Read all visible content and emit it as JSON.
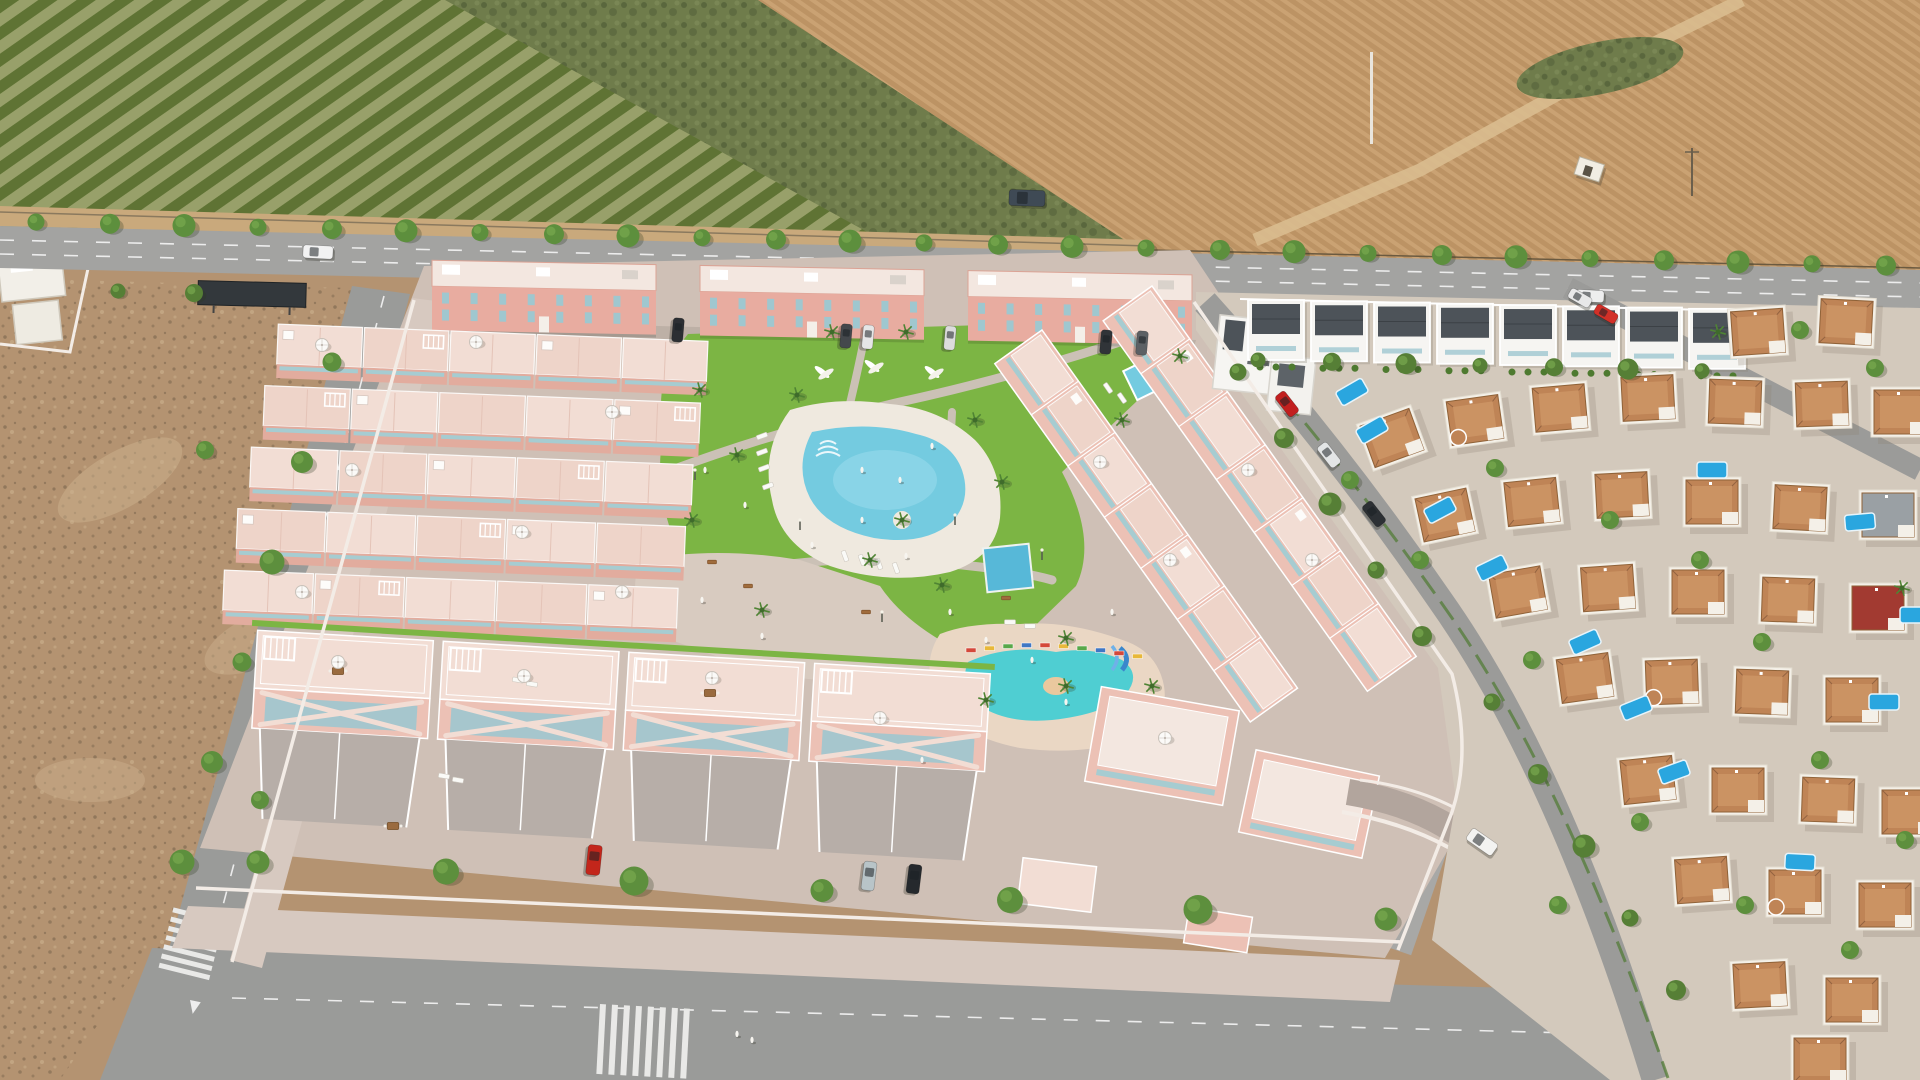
{
  "meta": {
    "title": "Aerial view of a new-build pink townhouse development with central pool park, bordered by orchards, plowed farmland, vacant lots and an existing villa neighborhood",
    "width": 1920,
    "height": 1080
  },
  "palette": {
    "orchardLight": "#98a06a",
    "orchardRow": "#5f7334",
    "scrub": "#6f7c4b",
    "scrubDark": "#55613a",
    "field": "#bc9364",
    "fieldLight": "#caa273",
    "track": "#d9bd8f",
    "shoulder": "#c9a97c",
    "fence": "#6b5a40",
    "roadA": "#a3a3a1",
    "roadB": "#9a9b99",
    "marking": "#ececec",
    "dirt": "#b49371",
    "dirtDark": "#6d5c45",
    "dirtLight": "#ccb18d",
    "pave": "#cfc0b6",
    "paveDark": "#bdb0a6",
    "walk": "#d7c9c0",
    "wallWhite": "#f3ece6",
    "pink": "#ecc1b5",
    "pinkDark": "#dba395",
    "pinkWall": "#e2ac9e",
    "terrace": "#f2ddd4",
    "terraceAlt": "#eed4c9",
    "facade": "#e8aca0",
    "roofWhite": "#f3e7e0",
    "teal": "#a6ccd1",
    "tealWin": "#9fc7cf",
    "grass": "#7cb544",
    "grassDark": "#639a35",
    "hedge": "#4e7a30",
    "treeFill": "#5d8f3d",
    "treeDark": "#466f2c",
    "palm": "#3f6b2b",
    "lagoon": "#74cbe0",
    "lagoonLight": "#9bdcec",
    "poolDeck": "#efe9df",
    "kidsPool": "#4fced2",
    "kidsDeck": "#ead7c4",
    "poolBlue": "#57b8d8",
    "privatePool": "#2aa6df",
    "villaWhite": "#f4f0e8",
    "villaRoof": "#bf8456",
    "villaRoofLight": "#d09a6a",
    "redRoof": "#a23a31",
    "grayRoof": "#9aa0a4",
    "modernRoof": "#4d5359",
    "neighborhoodGround": "#d3c9bc",
    "carWhite": "#f2f2f2",
    "carRed": "#c3261b",
    "carDark": "#25292d",
    "carSilver": "#b8c4c8",
    "vanDark": "#3f4a55"
  },
  "scene": {
    "regions": [
      {
        "name": "orchard-field",
        "desc": "row-planted orchard, top left"
      },
      {
        "name": "scrubland",
        "desc": "unplanted scrub, top centre"
      },
      {
        "name": "plowed-field",
        "desc": "brown plowed farmland, top right"
      },
      {
        "name": "main-road",
        "desc": "tree-lined avenue across the top"
      },
      {
        "name": "development",
        "desc": "pink render: townhouses around pool park"
      },
      {
        "name": "vacant-lot",
        "desc": "dirt plot, lower left"
      },
      {
        "name": "villa-neighborhood",
        "desc": "existing white villas with private pools, right"
      }
    ]
  },
  "objects": {
    "tree_rows": [
      {
        "name": "main-road-north",
        "x0": 36,
        "y0": 222,
        "dx": 74,
        "dy": 1.74,
        "n": 26,
        "r": 10,
        "color": "#5d8f3d"
      },
      {
        "name": "main-road-south-west",
        "x0": 118,
        "y0": 291,
        "dx": 76,
        "dy": 2,
        "n": 2,
        "r": 9,
        "color": "#567f36"
      },
      {
        "name": "main-road-south-east",
        "x0": 1258,
        "y0": 360,
        "dx": 74,
        "dy": 1.8,
        "n": 7,
        "r": 9,
        "color": "#567f36"
      },
      {
        "name": "left-road",
        "x0": 332,
        "y0": 362,
        "dx": -30,
        "dy": 100,
        "n": 6,
        "r": 11,
        "color": "#5d8f3d"
      },
      {
        "name": "bottom-sidewalk",
        "x0": 258,
        "y0": 862,
        "dx": 188,
        "dy": 9.5,
        "n": 7,
        "r": 13,
        "color": "#5d8f3d"
      },
      {
        "name": "development-street",
        "x0": 1238,
        "y0": 372,
        "dx": 46,
        "dy": 66,
        "n": 5,
        "r": 10,
        "color": "#567f36"
      },
      {
        "name": "neighborhood-street-lower",
        "x0": 1492,
        "y0": 702,
        "dx": 46,
        "dy": 72,
        "n": 5,
        "r": 10,
        "color": "#567f36"
      }
    ],
    "trees": [
      [
        1350,
        480
      ],
      [
        1495,
        468
      ],
      [
        1420,
        560
      ],
      [
        1610,
        520
      ],
      [
        1700,
        560
      ],
      [
        1762,
        642
      ],
      [
        1532,
        660
      ],
      [
        1820,
        760
      ],
      [
        1640,
        822
      ],
      [
        1745,
        905
      ],
      [
        1850,
        950
      ],
      [
        1905,
        840
      ],
      [
        1558,
        905
      ],
      [
        260,
        800
      ],
      [
        205,
        450
      ],
      [
        1875,
        368
      ],
      [
        1800,
        330
      ]
    ],
    "palms": [
      [
        700,
        390
      ],
      [
        737,
        455
      ],
      [
        692,
        520
      ],
      [
        797,
        395
      ],
      [
        975,
        420
      ],
      [
        1002,
        482
      ],
      [
        870,
        560
      ],
      [
        942,
        585
      ],
      [
        1066,
        638
      ],
      [
        1152,
        686
      ],
      [
        986,
        700
      ],
      [
        762,
        610
      ],
      [
        1122,
        420
      ],
      [
        1180,
        356
      ],
      [
        906,
        332
      ],
      [
        832,
        332
      ],
      [
        1066,
        686
      ],
      [
        902,
        520
      ],
      [
        1718,
        332
      ],
      [
        1902,
        588
      ]
    ],
    "cars": [
      {
        "n": "car-white-road",
        "x": 318,
        "y": 252,
        "rot": 3,
        "c": "#f2f2f2",
        "w": 30,
        "h": 13
      },
      {
        "n": "car-white-road-2",
        "x": 1590,
        "y": 296,
        "rot": 3,
        "c": "#eeeeee",
        "w": 28,
        "h": 12
      },
      {
        "n": "van-field",
        "x": 1027,
        "y": 198,
        "rot": 2,
        "c": "#3f4a55",
        "w": 36,
        "h": 16
      },
      {
        "n": "car-parked-1",
        "x": 678,
        "y": 330,
        "rot": 95,
        "c": "#2c2f33",
        "w": 24,
        "h": 11
      },
      {
        "n": "car-parked-2",
        "x": 846,
        "y": 336,
        "rot": 95,
        "c": "#44484c",
        "w": 24,
        "h": 11
      },
      {
        "n": "car-parked-3",
        "x": 868,
        "y": 337,
        "rot": 95,
        "c": "#e6e6e6",
        "w": 24,
        "h": 11
      },
      {
        "n": "car-parked-4",
        "x": 950,
        "y": 338,
        "rot": 95,
        "c": "#dcdcdc",
        "w": 24,
        "h": 11
      },
      {
        "n": "car-parked-5",
        "x": 1106,
        "y": 342,
        "rot": 95,
        "c": "#303438",
        "w": 24,
        "h": 11
      },
      {
        "n": "car-parked-6",
        "x": 1142,
        "y": 343,
        "rot": 95,
        "c": "#5c6064",
        "w": 24,
        "h": 11
      },
      {
        "n": "car-red-driveway",
        "x": 594,
        "y": 860,
        "rot": 96,
        "c": "#c3261b",
        "w": 30,
        "h": 14
      },
      {
        "n": "car-silver-driveway",
        "x": 869,
        "y": 876,
        "rot": 97,
        "c": "#b8c4c8",
        "w": 29,
        "h": 13
      },
      {
        "n": "car-black-driveway",
        "x": 914,
        "y": 879,
        "rot": 97,
        "c": "#25292d",
        "w": 29,
        "h": 13
      },
      {
        "n": "suv-white-ramp",
        "x": 1482,
        "y": 842,
        "rot": 35,
        "c": "#f3f3f1",
        "w": 31,
        "h": 14
      },
      {
        "n": "car-red-street",
        "x": 1287,
        "y": 404,
        "rot": 52,
        "c": "#c21f1f",
        "w": 26,
        "h": 12
      },
      {
        "n": "car-white-street",
        "x": 1329,
        "y": 455,
        "rot": 52,
        "c": "#e3e5e6",
        "w": 26,
        "h": 12
      },
      {
        "n": "car-dark-street",
        "x": 1374,
        "y": 514,
        "rot": 52,
        "c": "#2c3034",
        "w": 26,
        "h": 12
      },
      {
        "n": "car-white-street-2",
        "x": 1580,
        "y": 298,
        "rot": 30,
        "c": "#e8e8e8",
        "w": 24,
        "h": 11
      },
      {
        "n": "car-red-street-2",
        "x": 1606,
        "y": 314,
        "rot": 30,
        "c": "#d23028",
        "w": 24,
        "h": 11
      }
    ],
    "villas": [
      [
        1758,
        332,
        -4,
        0
      ],
      [
        1846,
        322,
        3,
        0
      ],
      [
        1392,
        438,
        -20,
        0
      ],
      [
        1475,
        420,
        -8,
        1
      ],
      [
        1560,
        408,
        -5,
        0
      ],
      [
        1648,
        398,
        -3,
        0
      ],
      [
        1735,
        402,
        2,
        0
      ],
      [
        1822,
        404,
        -2,
        0
      ],
      [
        1900,
        412,
        0,
        0
      ],
      [
        1445,
        515,
        -12,
        0
      ],
      [
        1532,
        502,
        -6,
        0
      ],
      [
        1622,
        495,
        -3,
        0
      ],
      [
        1712,
        502,
        0,
        0
      ],
      [
        1800,
        508,
        3,
        0
      ],
      [
        1888,
        515,
        0,
        3
      ],
      [
        1518,
        592,
        -10,
        0
      ],
      [
        1608,
        588,
        -4,
        0
      ],
      [
        1698,
        592,
        0,
        0
      ],
      [
        1788,
        600,
        2,
        0
      ],
      [
        1878,
        608,
        0,
        2
      ],
      [
        1585,
        678,
        -8,
        0
      ],
      [
        1672,
        682,
        -2,
        1
      ],
      [
        1762,
        692,
        2,
        0
      ],
      [
        1852,
        700,
        0,
        0
      ],
      [
        1648,
        780,
        -6,
        0
      ],
      [
        1738,
        790,
        0,
        0
      ],
      [
        1828,
        800,
        2,
        0
      ],
      [
        1908,
        812,
        0,
        0
      ],
      [
        1702,
        880,
        -4,
        0
      ],
      [
        1795,
        892,
        0,
        1
      ],
      [
        1885,
        905,
        0,
        0
      ],
      [
        1760,
        985,
        -3,
        0
      ],
      [
        1852,
        1000,
        0,
        0
      ],
      [
        1820,
        1060,
        0,
        0
      ]
    ],
    "private_pools": [
      [
        1372,
        430,
        -30
      ],
      [
        1440,
        510,
        -28
      ],
      [
        1492,
        568,
        -26
      ],
      [
        1585,
        642,
        -24
      ],
      [
        1636,
        708,
        -22
      ],
      [
        1674,
        772,
        -20
      ],
      [
        1712,
        470,
        0
      ],
      [
        1860,
        522,
        -5
      ],
      [
        1884,
        702,
        0
      ],
      [
        1800,
        862,
        3
      ],
      [
        1352,
        392,
        -30
      ],
      [
        1915,
        615,
        0
      ]
    ],
    "modern_row": {
      "x0": 1248,
      "step": 63,
      "n": 8,
      "y0": 300,
      "slope": 0.02,
      "w": 56,
      "h": 60
    },
    "top_blocks": [
      {
        "x": 432,
        "w": 224
      },
      {
        "x": 700,
        "w": 224
      },
      {
        "x": 968,
        "w": 224
      }
    ],
    "matrix": {
      "cx": 470,
      "cy": 560,
      "rot": 2.3,
      "h": 54,
      "rows": [
        {
          "x": 268,
          "y": 332,
          "w": 432,
          "units": 5
        },
        {
          "x": 257,
          "y": 394,
          "w": 438,
          "units": 5
        },
        {
          "x": 246,
          "y": 456,
          "w": 444,
          "units": 5
        },
        {
          "x": 235,
          "y": 518,
          "w": 450,
          "units": 5
        },
        {
          "x": 224,
          "y": 580,
          "w": 456,
          "units": 5
        }
      ]
    },
    "front": {
      "cx": 620,
      "cy": 770,
      "rot": 3.4,
      "y": 652,
      "w": 176,
      "terH": 58,
      "facH": 40,
      "driveH": 90,
      "units": [
        250,
        436,
        622,
        808
      ]
    },
    "right_rows": [
      {
        "x": 1152,
        "y": 286,
        "len": 455,
        "w": 60,
        "rot": 54.5,
        "units": 7
      },
      {
        "x": 1042,
        "y": 330,
        "len": 440,
        "w": 58,
        "rot": 54.5,
        "units": 7
      }
    ],
    "umbrellas": [
      [
        322,
        345
      ],
      [
        476,
        342
      ],
      [
        612,
        412
      ],
      [
        352,
        470
      ],
      [
        522,
        532
      ],
      [
        302,
        592
      ],
      [
        622,
        592
      ],
      [
        338,
        662
      ],
      [
        524,
        676
      ],
      [
        712,
        678
      ],
      [
        880,
        718
      ],
      [
        1100,
        462
      ],
      [
        1248,
        470
      ],
      [
        1170,
        560
      ],
      [
        1312,
        560
      ],
      [
        1165,
        738
      ]
    ],
    "loungers": [
      [
        762,
        436,
        -20
      ],
      [
        762,
        452,
        -20
      ],
      [
        764,
        468,
        -20
      ],
      [
        768,
        486,
        -20
      ],
      [
        845,
        556,
        70
      ],
      [
        862,
        560,
        70
      ],
      [
        879,
        564,
        70
      ],
      [
        896,
        568,
        70
      ],
      [
        1108,
        388,
        55
      ],
      [
        1122,
        398,
        55
      ],
      [
        1010,
        622,
        0
      ],
      [
        1030,
        626,
        0
      ],
      [
        444,
        776,
        10
      ],
      [
        458,
        780,
        10
      ],
      [
        518,
        680,
        10
      ],
      [
        532,
        684,
        10
      ]
    ],
    "people": [
      [
        705,
        470
      ],
      [
        745,
        505
      ],
      [
        812,
        545
      ],
      [
        862,
        520
      ],
      [
        906,
        556
      ],
      [
        950,
        612
      ],
      [
        986,
        640
      ],
      [
        1032,
        660
      ],
      [
        1066,
        702
      ],
      [
        900,
        480
      ],
      [
        932,
        446
      ],
      [
        862,
        470
      ],
      [
        702,
        600
      ],
      [
        762,
        636
      ],
      [
        1112,
        612
      ],
      [
        737,
        1034
      ],
      [
        752,
        1040
      ],
      [
        922,
        760
      ]
    ],
    "sculptures": [
      [
        822,
        372
      ],
      [
        872,
        366
      ],
      [
        932,
        372
      ]
    ],
    "lamps": [
      [
        695,
        480
      ],
      [
        800,
        530
      ],
      [
        955,
        525
      ],
      [
        1042,
        560
      ],
      [
        882,
        622
      ],
      [
        1092,
        480
      ],
      [
        662,
        560
      ]
    ],
    "benches": [
      [
        712,
        562
      ],
      [
        866,
        612
      ],
      [
        1006,
        598
      ],
      [
        748,
        586
      ]
    ],
    "tables": [
      [
        338,
        671
      ],
      [
        710,
        693
      ],
      [
        393,
        826
      ]
    ],
    "kids_fence": {
      "x0": 966,
      "dx": 18.5,
      "n": 10,
      "colors": [
        "#d4483a",
        "#e8b83a",
        "#58a84a",
        "#3f77c4"
      ],
      "ys": [
        648,
        646,
        644,
        643,
        643,
        644,
        646,
        648,
        651,
        654
      ]
    },
    "crosswalks": [
      {
        "x": 224,
        "y": 920,
        "rot": 104,
        "n": 7,
        "w": 5,
        "h": 52,
        "gap": 4.5
      },
      {
        "x": 600,
        "y": 1004,
        "rot": 3,
        "n": 8,
        "w": 6,
        "h": 70,
        "gap": 6
      },
      {
        "x": 1622,
        "y": 882,
        "rot": 56,
        "n": 6,
        "w": 5,
        "h": 30,
        "gap": 4
      }
    ]
  }
}
